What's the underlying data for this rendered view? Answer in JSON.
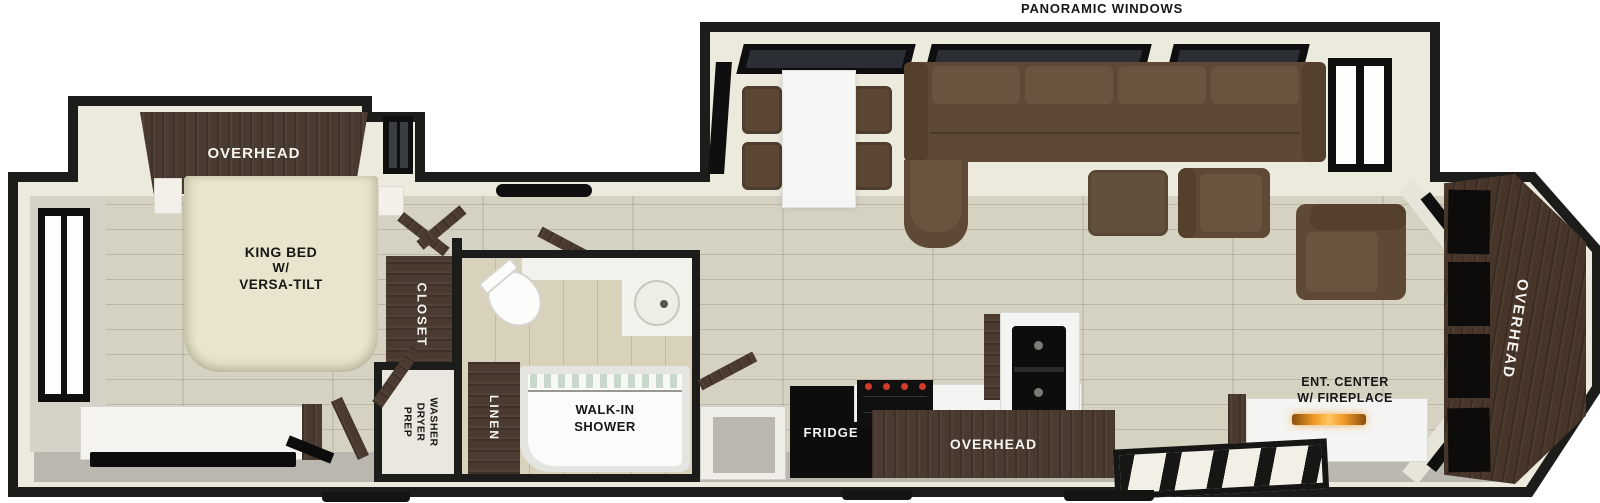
{
  "labels": {
    "panoramic_windows": "PANORAMIC WINDOWS",
    "bedroom_overhead": "OVERHEAD",
    "king_bed_line1": "KING BED",
    "king_bed_line2": "W/",
    "king_bed_line3": "VERSA-TILT",
    "closet": "CLOSET",
    "washer_line1": "WASHER",
    "washer_line2": "DRYER",
    "washer_line3": "PREP",
    "linen": "LINEN",
    "shower_line1": "WALK-IN",
    "shower_line2": "SHOWER",
    "fridge": "FRIDGE",
    "kitchen_overhead": "OVERHEAD",
    "ent_center_line1": "ENT. CENTER",
    "ent_center_line2": "W/ FIREPLACE",
    "rear_overhead": "OVERHEAD"
  },
  "colors": {
    "wall": "#1c1c1a",
    "trim": "#ece9dd",
    "floor": "#d6d2c2",
    "walkway": "#b9b7ae",
    "cabinet": "#4a3a2f",
    "sofa": "#5e4936",
    "sofa_cushion": "#6a5440",
    "bed": "#e9e4cd",
    "white": "#f4f4f2",
    "black": "#0d0d0d",
    "red": "#d13b2a",
    "fire": "#f09a27",
    "glass": "#2b2f35"
  }
}
